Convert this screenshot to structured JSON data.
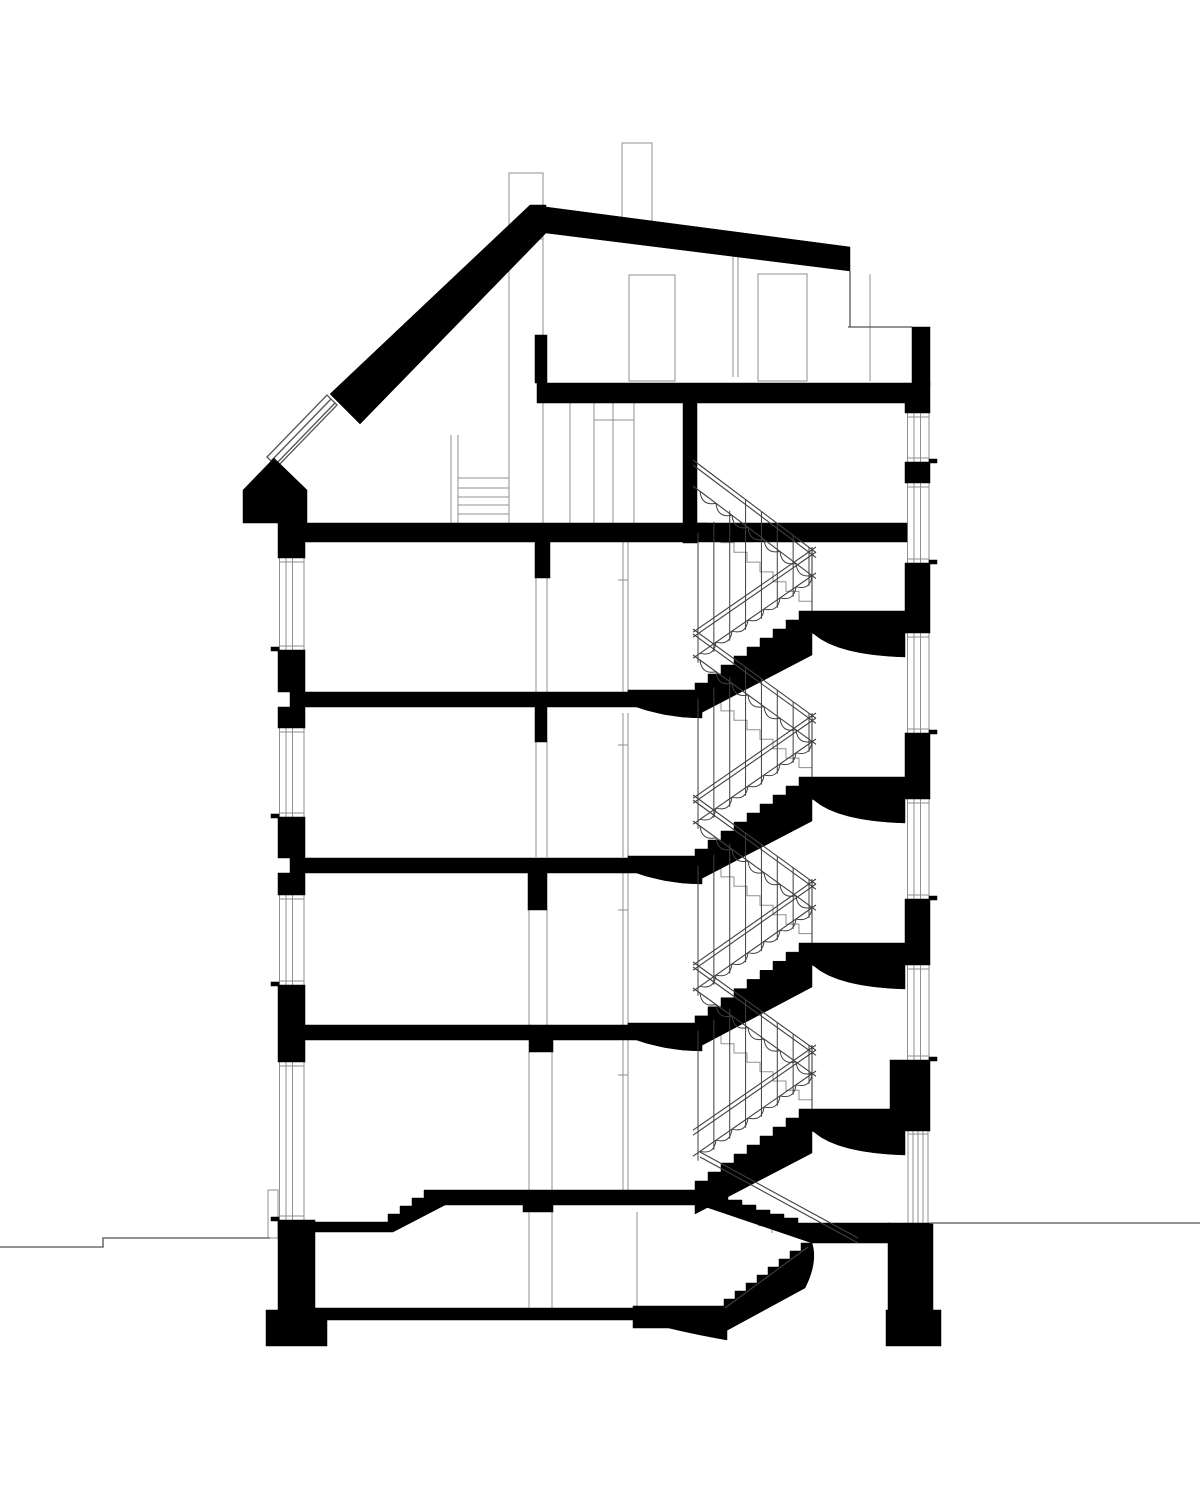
{
  "meta": {
    "type": "architectural-building-cross-section",
    "canvas_w": 1200,
    "canvas_h": 1500
  },
  "palette": {
    "ink": "#000000",
    "bg": "#ffffff",
    "thin": "#8f8f8f",
    "med": "#555555",
    "rail": "#3f3f3f",
    "ground": "#6f6f6f"
  },
  "drawing": {
    "black_rects": [
      [
        278,
        520,
        27,
        38
      ],
      [
        278,
        650,
        27,
        42
      ],
      [
        278,
        707,
        27,
        21
      ],
      [
        278,
        817,
        27,
        41
      ],
      [
        278,
        873,
        27,
        22
      ],
      [
        278,
        985,
        27,
        77
      ],
      [
        278,
        1220,
        37,
        92
      ],
      [
        266,
        1310,
        61,
        36
      ],
      [
        912,
        327,
        18,
        58
      ],
      [
        905,
        383,
        25,
        30
      ],
      [
        905,
        462,
        25,
        21
      ],
      [
        905,
        563,
        25,
        70
      ],
      [
        905,
        733,
        25,
        66
      ],
      [
        905,
        899,
        25,
        66
      ],
      [
        890,
        1060,
        40,
        71
      ],
      [
        888,
        1223,
        45,
        87
      ],
      [
        886,
        1310,
        55,
        36
      ],
      [
        290,
        523,
        617,
        19
      ],
      [
        537,
        383,
        368,
        20
      ],
      [
        535,
        335,
        12,
        48
      ],
      [
        290,
        692,
        378,
        15
      ],
      [
        290,
        858,
        378,
        15
      ],
      [
        290,
        1025,
        378,
        15
      ],
      [
        315,
        1308,
        412,
        12
      ],
      [
        633,
        1320,
        56,
        8
      ],
      [
        683,
        403,
        14,
        140
      ],
      [
        535,
        542,
        15,
        36
      ],
      [
        535,
        707,
        12,
        35
      ],
      [
        528,
        873,
        19,
        37
      ],
      [
        529,
        1040,
        24,
        12
      ],
      [
        523,
        1205,
        30,
        7
      ]
    ],
    "black_paths": [
      "M330,394 L530,205 L546,205 L546,233 L360,424 Z",
      "M546,207 L850,247 L850,271 L546,233 Z",
      "M243,490 L274,458 L307,490 L307,523 L243,523 Z",
      "M305,1222 L388,1222 L388,1214 L400,1214 L400,1206 L412,1206 L412,1198 L424,1198 L424,1190 L714,1190 L714,1195 L728,1195 L728,1200 L742,1200 L742,1205 L756,1205 L756,1210 L770,1210 L770,1214 L784,1214 L784,1218 L798,1218 L798,1223 L890,1223 L890,1243 L812,1243 L700,1205 L445,1205 L393,1232 L305,1232 Z",
      "M812,1243 L801,1243 L801,1251 L790,1251 L790,1259 L779,1259 L779,1267 L768,1267 L768,1275 L757,1275 L757,1283 L746,1283 L746,1291 L735,1291 L735,1299 L724,1299 L724,1332 L805,1288 Q818,1262 812,1243 Z",
      "M633,1306 L727,1306 L727,1340 Q670,1330 633,1318 Z"
    ],
    "coves_floors": [
      692,
      858,
      1025
    ],
    "stairs": {
      "x_left": 695,
      "x_right": 812,
      "floors": [
        523,
        692,
        858,
        1025,
        1190
      ],
      "landings": [
        611,
        777,
        943,
        1109
      ],
      "steps": 9,
      "landing_w": 93,
      "landing_h": 22,
      "arch_depth": 24,
      "rail_drop": 63,
      "rail_offsets": [
        0,
        5,
        26
      ],
      "scallop_r": 8,
      "scallop_count": 7,
      "baluster_count": 8,
      "baluster_max": 130
    },
    "left_windows": [
      [
        558,
        650
      ],
      [
        728,
        817
      ],
      [
        895,
        985
      ],
      [
        1062,
        1220
      ]
    ],
    "right_windows": [
      [
        413,
        462
      ],
      [
        483,
        563
      ],
      [
        633,
        733
      ],
      [
        799,
        899
      ],
      [
        965,
        1060
      ]
    ],
    "left_frame_x": [
      279.5,
      286,
      292.5,
      304
    ],
    "right_frame_x": [
      907.5,
      914,
      920.5,
      929
    ],
    "thin_rects": [
      [
        509,
        173,
        34,
        66
      ],
      [
        622,
        143,
        30,
        78
      ],
      [
        629,
        275,
        46,
        106
      ],
      [
        758,
        274,
        49,
        107
      ],
      [
        268,
        1190,
        10,
        48
      ]
    ],
    "thin_lines": [
      [
        509,
        269,
        509,
        523
      ],
      [
        543,
        236,
        543,
        523
      ],
      [
        570,
        403,
        570,
        523
      ],
      [
        594,
        403,
        594,
        523
      ],
      [
        613,
        403,
        613,
        523
      ],
      [
        634,
        403,
        634,
        523
      ],
      [
        594,
        420,
        634,
        420
      ],
      [
        733,
        255,
        733,
        377
      ],
      [
        738,
        255,
        738,
        377
      ],
      [
        870,
        274,
        870,
        381
      ],
      [
        451,
        435,
        451,
        523
      ],
      [
        458,
        435,
        458,
        523
      ],
      [
        458,
        478,
        509,
        478
      ],
      [
        458,
        488,
        509,
        488
      ],
      [
        458,
        497,
        509,
        497
      ],
      [
        458,
        505,
        509,
        505
      ],
      [
        458,
        514,
        509,
        514
      ],
      [
        536,
        578,
        536,
        692
      ],
      [
        547,
        578,
        547,
        692
      ],
      [
        536,
        742,
        536,
        857
      ],
      [
        547,
        742,
        547,
        857
      ],
      [
        529,
        910,
        529,
        1025
      ],
      [
        547,
        910,
        547,
        1025
      ],
      [
        529,
        1052,
        529,
        1190
      ],
      [
        552,
        1052,
        552,
        1190
      ],
      [
        529,
        1212,
        529,
        1308
      ],
      [
        552,
        1212,
        552,
        1308
      ],
      [
        637,
        1212,
        637,
        1308
      ],
      [
        623,
        542,
        623,
        692
      ],
      [
        628,
        542,
        628,
        692
      ],
      [
        618,
        580,
        628,
        580
      ],
      [
        623,
        713,
        623,
        857
      ],
      [
        628,
        713,
        628,
        857
      ],
      [
        618,
        745,
        628,
        745
      ],
      [
        623,
        873,
        623,
        1025
      ],
      [
        628,
        873,
        628,
        1025
      ],
      [
        618,
        910,
        628,
        910
      ],
      [
        623,
        1040,
        623,
        1190
      ],
      [
        628,
        1040,
        628,
        1190
      ],
      [
        618,
        1075,
        628,
        1075
      ],
      [
        908,
        1131,
        908,
        1223
      ],
      [
        913,
        1131,
        913,
        1223
      ],
      [
        918,
        1131,
        918,
        1223
      ],
      [
        923,
        1131,
        923,
        1223
      ],
      [
        928,
        1131,
        928,
        1223
      ],
      [
        908,
        1134,
        928,
        1134
      ]
    ],
    "med_lines": [
      [
        850,
        271,
        850,
        327
      ],
      [
        848,
        327,
        912,
        327
      ],
      [
        271,
        461,
        331,
        399
      ],
      [
        275,
        465,
        335,
        403
      ]
    ],
    "med_paths": [
      "M267,457 L327,395 L337,405 L277,467 Z"
    ],
    "gray_zigzags_extra": [
      [
        706,
        1196,
        772,
        1233,
        5
      ]
    ],
    "rail_lines_extra": [
      [
        700,
        1152,
        858,
        1238
      ],
      [
        700,
        1157,
        858,
        1243
      ],
      [
        808,
        1247,
        725,
        1308
      ]
    ],
    "ground_polylines": [
      [
        [
          0,
          1247
        ],
        [
          103,
          1247
        ],
        [
          103,
          1238
        ],
        [
          270,
          1238
        ]
      ],
      [
        [
          930,
          1223
        ],
        [
          1200,
          1223
        ]
      ]
    ]
  }
}
